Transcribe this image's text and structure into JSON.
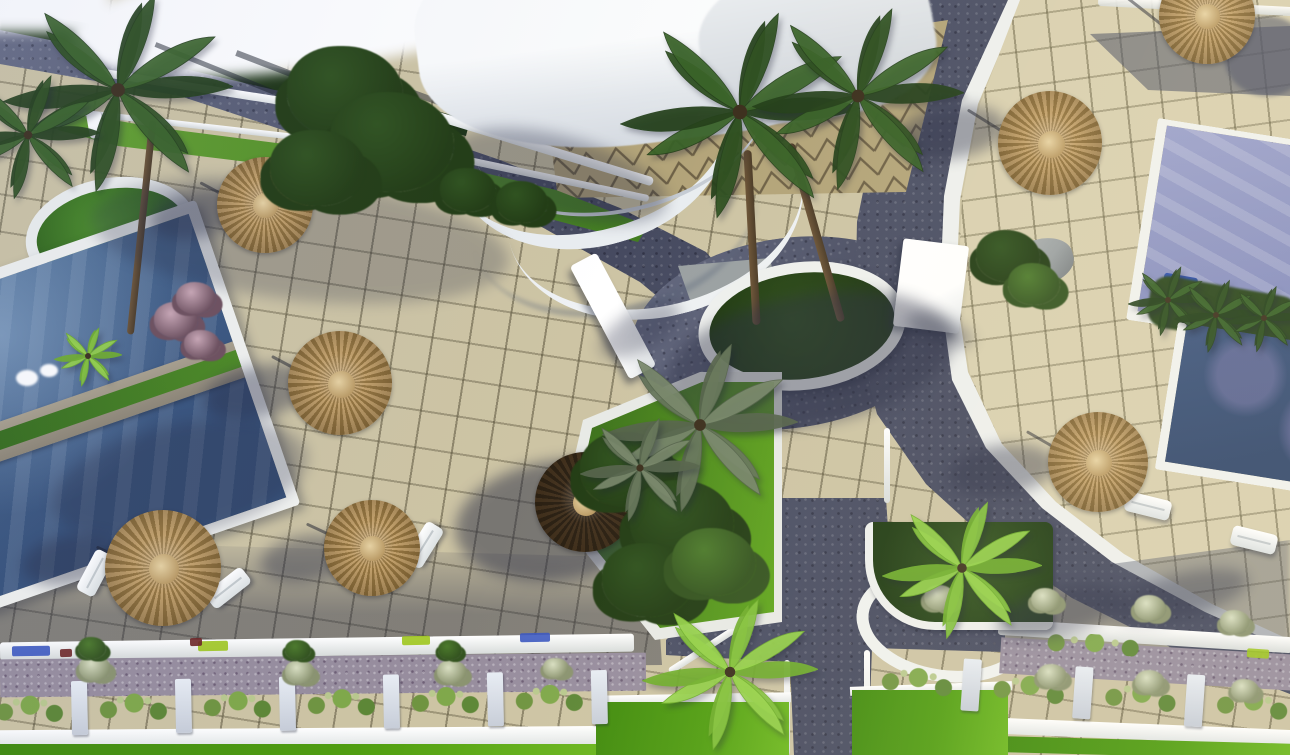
{
  "scene": {
    "description": "Aerial 3D architectural rendering of a resort courtyard: beige tiled sun decks with straw parasols and white loungers, two dark-blue pools on the left, periwinkle pools on the right, a white curved canopy building at top, dark Y-shaped paved roads with white curbs, circular palm planters, dense green landscaping, and a bottom street lined with hedge planter boxes and bright lawn",
    "counts": {
      "pools": 3,
      "parasols": 8,
      "sun_loungers": 5,
      "palm_canopies": 12,
      "planter_boxes": 10
    },
    "parasols": [
      [
        265,
        205,
        48,
        "tan"
      ],
      [
        340,
        383,
        52,
        "tan"
      ],
      [
        163,
        568,
        58,
        "tan"
      ],
      [
        372,
        548,
        48,
        "tan"
      ],
      [
        585,
        502,
        50,
        "dark"
      ],
      [
        1050,
        143,
        52,
        "tan"
      ],
      [
        1207,
        16,
        48,
        "tan"
      ],
      [
        1098,
        462,
        50,
        "tan"
      ]
    ],
    "loungers": [
      [
        95,
        573,
        -62
      ],
      [
        228,
        588,
        -38
      ],
      [
        424,
        545,
        -58
      ],
      [
        1148,
        506,
        14
      ],
      [
        1254,
        540,
        14
      ]
    ],
    "palms": [
      [
        118,
        90,
        115,
        "dark"
      ],
      [
        28,
        135,
        72,
        "dark"
      ],
      [
        740,
        112,
        120,
        "dark"
      ],
      [
        858,
        96,
        106,
        "dark"
      ],
      [
        700,
        425,
        98,
        "gray"
      ],
      [
        962,
        568,
        80,
        "bright"
      ],
      [
        730,
        672,
        88,
        "bright"
      ],
      [
        88,
        356,
        34,
        "bright"
      ],
      [
        1168,
        300,
        40,
        "dark"
      ],
      [
        1216,
        315,
        42,
        "dark"
      ],
      [
        1264,
        318,
        38,
        "dark"
      ],
      [
        640,
        468,
        60,
        "gray"
      ]
    ],
    "bushes": [
      [
        345,
        92,
        58,
        "dark"
      ],
      [
        392,
        142,
        62,
        "dark"
      ],
      [
        318,
        168,
        48,
        "dark"
      ],
      [
        468,
        190,
        28,
        "dark"
      ],
      [
        522,
        202,
        26,
        "dark"
      ],
      [
        628,
        470,
        48,
        "dark"
      ],
      [
        682,
        522,
        52,
        "dark"
      ],
      [
        648,
        580,
        46,
        "dark"
      ],
      [
        714,
        562,
        42,
        "mid"
      ],
      [
        1008,
        256,
        32,
        "dark"
      ],
      [
        1034,
        284,
        26,
        "mid"
      ],
      [
        176,
        320,
        22,
        "pink"
      ],
      [
        202,
        344,
        18,
        "pink"
      ],
      [
        196,
        298,
        20,
        "pink"
      ],
      [
        940,
        598,
        16,
        "pale"
      ],
      [
        1046,
        600,
        15,
        "pale"
      ],
      [
        1150,
        608,
        16,
        "pale"
      ],
      [
        1235,
        622,
        15,
        "pale"
      ],
      [
        95,
        668,
        16,
        "pale"
      ],
      [
        300,
        672,
        15,
        "pale"
      ],
      [
        452,
        672,
        15,
        "pale"
      ],
      [
        556,
        668,
        13,
        "pale"
      ],
      [
        1052,
        676,
        15,
        "pale"
      ],
      [
        1150,
        682,
        15,
        "pale"
      ],
      [
        1245,
        690,
        14,
        "pale"
      ],
      [
        92,
        648,
        14,
        "mid"
      ],
      [
        298,
        650,
        13,
        "mid"
      ],
      [
        450,
        650,
        12,
        "mid"
      ]
    ],
    "shadow_blobs": [
      [
        300,
        240,
        420,
        120,
        6,
        0.26
      ],
      [
        180,
        480,
        260,
        110,
        -12,
        0.28
      ],
      [
        810,
        360,
        290,
        130,
        -10,
        0.42
      ],
      [
        560,
        520,
        210,
        120,
        -8,
        0.5
      ],
      [
        196,
        214,
        95,
        48,
        -12,
        0.4
      ],
      [
        258,
        392,
        110,
        52,
        -12,
        0.42
      ],
      [
        72,
        560,
        100,
        50,
        -10,
        0.4
      ],
      [
        306,
        558,
        92,
        46,
        -10,
        0.4
      ],
      [
        952,
        132,
        108,
        52,
        -8,
        0.42
      ],
      [
        1002,
        470,
        108,
        50,
        -8,
        0.42
      ],
      [
        560,
        176,
        220,
        80,
        15,
        0.32
      ],
      [
        640,
        330,
        90,
        40,
        -30,
        0.3
      ],
      [
        1060,
        612,
        130,
        46,
        -14,
        0.4
      ],
      [
        1180,
        596,
        140,
        44,
        -14,
        0.38
      ],
      [
        940,
        330,
        70,
        26,
        20,
        0.35
      ]
    ],
    "pole_shadows": [
      [
        1178,
        36,
        130,
        38
      ],
      [
        1044,
        156,
        90,
        32
      ],
      [
        262,
        214,
        70,
        28
      ],
      [
        338,
        390,
        75,
        28
      ],
      [
        160,
        575,
        70,
        25
      ],
      [
        370,
        552,
        70,
        25
      ],
      [
        1096,
        470,
        80,
        30
      ]
    ],
    "planter_rows": [
      {
        "x": -15,
        "y": 686,
        "angle": -1.2,
        "count": 6,
        "pitch": 104,
        "box_w": 86,
        "box_h": 48,
        "post_w": 16
      },
      {
        "x": 872,
        "y": 655,
        "angle": 4,
        "count": 4,
        "pitch": 112,
        "box_w": 92,
        "box_h": 46,
        "post_w": 18
      }
    ],
    "curb_tabs": [
      [
        12,
        646,
        38,
        10,
        -1,
        "blue"
      ],
      [
        198,
        641,
        30,
        10,
        -1,
        "lime"
      ],
      [
        402,
        636,
        28,
        9,
        -1,
        "lime"
      ],
      [
        520,
        633,
        30,
        9,
        -1,
        "blue"
      ],
      [
        1247,
        649,
        22,
        9,
        4,
        "lime"
      ],
      [
        60,
        649,
        12,
        8,
        -1,
        "maroon"
      ],
      [
        190,
        638,
        12,
        8,
        -1,
        "maroon"
      ]
    ]
  },
  "colors": {
    "tile_left": "#cdc4a4",
    "tile_right": "#d9d0b0",
    "tile_shadow": "#474c63",
    "road": "#575c73",
    "road_light": "#9298ad",
    "curb_white": "#f2f3f0",
    "pool_main": "#49698f",
    "pool_main_deep": "#36517a",
    "pool_right": "#8b92c2",
    "pool_right_deep": "#32486d",
    "grass": "#5d9b28",
    "lawn": "#4f9d10",
    "hedge": "#1d3414",
    "bush_dark": "#2a461c",
    "bush_mid": "#3f672a",
    "palm_bright": "#7fbc35",
    "parasol_tan": "#c2a06a",
    "parasol_tan2": "#93743f",
    "parasol_dark": "#43321f",
    "parasol_dark2": "#2a2014",
    "canopy": "#f4f6f7",
    "canopy_shade": "#d5dade",
    "zigzag_bg": "#b3a479",
    "zigzag_line": "#6e6146",
    "mauve": "#978d9e",
    "post": "#c7cdd8",
    "box_dark": "#20313c",
    "flower_pink": "#d8c4cf",
    "flower_pale": "#cfd6bc",
    "stone": "#9aa0a2",
    "equip_blue": "#2b4fae",
    "lime": "#9fc61d",
    "blue_tab": "#3a57c0",
    "maroon": "#6d2424",
    "shadow": "#262a42"
  }
}
